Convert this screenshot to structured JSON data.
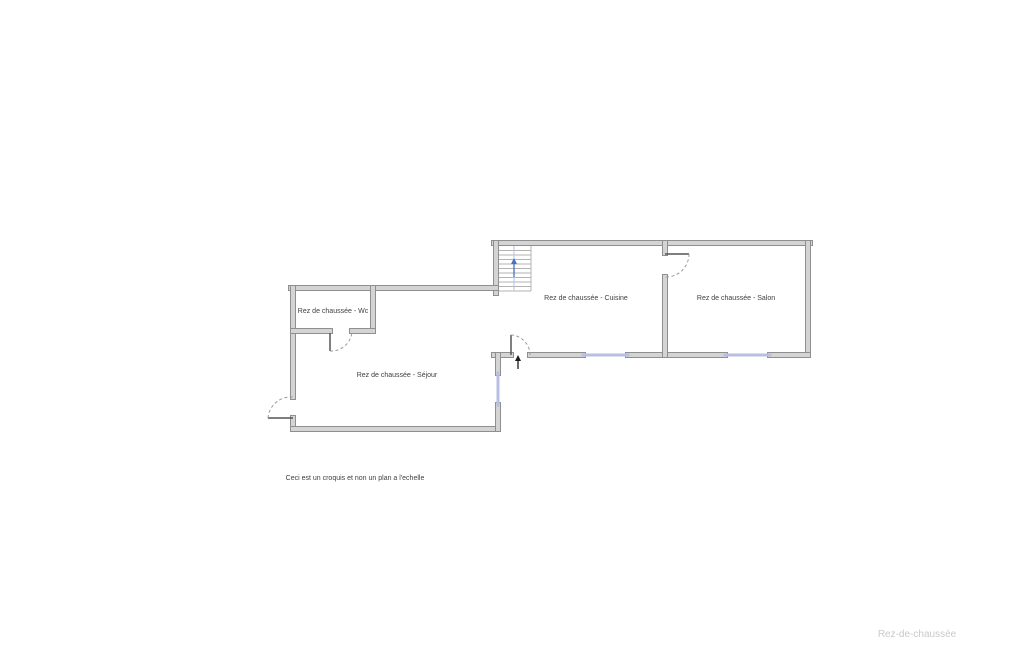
{
  "canvas": {
    "width": 1025,
    "height": 650,
    "background": "#ffffff"
  },
  "colors": {
    "wall_fill": "#d4d4d4",
    "wall_stroke": "#8f8f8f",
    "window_fill": "#b9bfe4",
    "door_leaf": "#555555",
    "door_arc": "#9a9a9a",
    "stair_line": "#b3b3b3",
    "stair_center_line": "#b9c2de",
    "stair_arrow": "#4472c4",
    "entry_arrow": "#1a1a1a",
    "label_color": "#3f3f3f",
    "watermark_color": "#c9c9c9"
  },
  "rooms": [
    {
      "id": "wc",
      "label": "Rez de chaussée - Wc",
      "x": 333,
      "y": 313
    },
    {
      "id": "sejour",
      "label": "Rez de chaussée - Séjour",
      "x": 397,
      "y": 377
    },
    {
      "id": "cuisine",
      "label": "Rez de chaussée - Cuisine",
      "x": 586,
      "y": 300
    },
    {
      "id": "salon",
      "label": "Rez de chaussée - Salon",
      "x": 736,
      "y": 300
    }
  ],
  "note": {
    "text": "Ceci est un croquis et non un plan a l'echelle",
    "x": 355,
    "y": 480
  },
  "watermark": {
    "text": "Rez-de-chaussée",
    "x": 917,
    "y": 637
  },
  "plan": {
    "wall_thickness": 5,
    "walls": [
      [
        494,
        243,
        810,
        243
      ],
      [
        808,
        243,
        808,
        355
      ],
      [
        494,
        355,
        511,
        355
      ],
      [
        530,
        355,
        583,
        355
      ],
      [
        628,
        355,
        725,
        355
      ],
      [
        770,
        355,
        808,
        355
      ],
      [
        496,
        243,
        496,
        293
      ],
      [
        665,
        243,
        665,
        253
      ],
      [
        665,
        277,
        665,
        355
      ],
      [
        291,
        288,
        496,
        288
      ],
      [
        293,
        288,
        293,
        397
      ],
      [
        293,
        418,
        293,
        429
      ],
      [
        293,
        429,
        498,
        429
      ],
      [
        498,
        355,
        498,
        373
      ],
      [
        498,
        405,
        498,
        429
      ],
      [
        373,
        288,
        373,
        331
      ],
      [
        293,
        331,
        330,
        331
      ],
      [
        352,
        331,
        373,
        331
      ]
    ],
    "window_thickness": 3,
    "windows": [
      [
        583,
        355,
        628,
        355
      ],
      [
        725,
        355,
        770,
        355
      ],
      [
        498,
        373,
        498,
        405
      ]
    ],
    "doors": [
      {
        "id": "wc-door",
        "leaf": [
          330,
          333,
          330,
          351
        ],
        "arc": "M 330 351 A 21 21 0 0 0 352 332"
      },
      {
        "id": "sejour-entry-door",
        "leaf": [
          268,
          418,
          293,
          418
        ],
        "arc": "M 268 418 A 23 23 0 0 1 293 397"
      },
      {
        "id": "cuisine-entry-door",
        "leaf": [
          511,
          335,
          511,
          355
        ],
        "arc": "M 511 335 A 20 20 0 0 1 530 355"
      },
      {
        "id": "cuisine-salon-door",
        "leaf": [
          665,
          254,
          689,
          254
        ],
        "arc": "M 689 254 A 23 23 0 0 1 665 277"
      }
    ],
    "stairs": {
      "x": 498,
      "y": 246,
      "w": 33,
      "h": 45,
      "treads": 10,
      "center_x": 514
    },
    "stair_arrow": {
      "x": 514,
      "y_tail": 277,
      "y_head": 258
    },
    "entry_arrow": {
      "x": 518,
      "y_tail": 369,
      "y_head": 355
    }
  }
}
